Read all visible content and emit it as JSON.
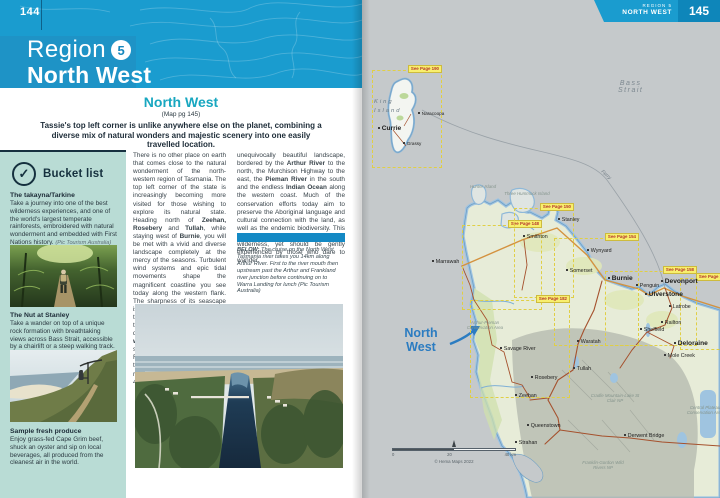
{
  "colors": {
    "header_blue": "#1a9ccf",
    "teal_heading": "#18a7c0",
    "sidebar_bg": "#b9dcd5",
    "divider_bar": "#1489c4",
    "map_sea": "#c5c9cb",
    "inset_yellow": "#f8ef6e",
    "nw_label_blue": "#2b7cc1"
  },
  "page_left": {
    "page_number": "144",
    "header": {
      "region_label": "Region",
      "region_number": "5",
      "region_name": "North West"
    },
    "section": {
      "title": "North West",
      "map_ref": "(Map pg 145)",
      "intro": "Tassie's top left corner is unlike anywhere else on the planet, combining a diverse mix of natural wonders and majestic scenery into one easily travelled location."
    },
    "bucket_list": {
      "title": "Bucket list",
      "icon": "check-circle",
      "items": [
        {
          "title": "The takayna/Tarkine",
          "body": "Take a journey into one of the best wilderness experiences, and one of the world's largest temperate rainforests, embroidered with natural wonderment and embedded with First Nations history.",
          "credit": "(Pic Tourism Australia)"
        },
        {
          "title": "The Nut at Stanley",
          "body": "Take a wander on top of a unique rock formation with breathtaking views across Bass Strait, accessible by a chairlift or a steep walking track.",
          "credit": "(Pic Lusy Productions)"
        },
        {
          "title": "Sample fresh produce",
          "body": "Enjoy grass-fed Cape Grim beef, shuck an oyster and sip on local beverages, all produced from the cleanest air in the world.",
          "credit": ""
        }
      ]
    },
    "article": {
      "col1": "There is no other place on earth that comes close to the natural wonderment of the north-western region of Tasmania. The top left corner of the state is increasingly becoming more visited for those wishing to explore its natural state. Heading north of **Zeehan, Rosebery** and **Tullah**, while staying west of **Burnie**, you will be met with a vivid and diverse landscape completely at the mercy of the seasons. Turbulent wind systems and epic tidal movements shape the magnificent coastline you see today along the western flank. The sharpness of its seascape is contrasted by the softness of the open moorlands and cool temperate rainforests found deep in the **takayna/Tarkine wilderness region**, culturally significant lands belonging to the First Nations people. The takayna/Tarkine wilderness region comprises nearly 448,000ha of",
      "col2": "unequivocally beautiful landscape, bordered by the **Arthur River** to the north, the Murchison Highway to the east, the **Pieman River** in the south and the endless **Indian Ocean** along the western coast. Much of the conservation efforts today aim to preserve the Aboriginal language and cultural connection with the land, as well as the endemic biodiversity. This part of Tasmania is a vast, untamed wilderness, yet should be gently experienced by those who dare to wander.",
      "caption": "**BELOW:** The cruise on the North West Tasmania river takes you 14km along Arthur River. First to the river mouth then upstream past the Arthur and Frankland river junction before continuing on to Warra Landing for lunch (Pic Tourism Australia)"
    }
  },
  "page_right": {
    "page_number": "145",
    "corner_tab": {
      "region": "REGION 5",
      "name": "NORTH WEST"
    },
    "map": {
      "sea_label": "Bass\nStrait",
      "region_label": "North\nWest",
      "ferry_label": "Ferry",
      "king_island_label": "King\nIsland",
      "towns": [
        {
          "label": "Currie",
          "x": 16,
          "y": 125,
          "cls": "big"
        },
        {
          "label": "Naracoopa",
          "x": 56,
          "y": 111,
          "cls": "sm"
        },
        {
          "label": "Grassy",
          "x": 41,
          "y": 141,
          "cls": "sm"
        },
        {
          "label": "Marrawah",
          "x": 70,
          "y": 259
        },
        {
          "label": "Smithton",
          "x": 161,
          "y": 234
        },
        {
          "label": "Stanley",
          "x": 196,
          "y": 217
        },
        {
          "label": "Wynyard",
          "x": 225,
          "y": 248
        },
        {
          "label": "Somerset",
          "x": 204,
          "y": 268
        },
        {
          "label": "Burnie",
          "x": 246,
          "y": 275,
          "cls": "big"
        },
        {
          "label": "Penguin",
          "x": 274,
          "y": 283
        },
        {
          "label": "Ulverstone",
          "x": 283,
          "y": 291,
          "cls": "big"
        },
        {
          "label": "Devonport",
          "x": 299,
          "y": 278,
          "cls": "big"
        },
        {
          "label": "Latrobe",
          "x": 307,
          "y": 304
        },
        {
          "label": "Railton",
          "x": 299,
          "y": 320
        },
        {
          "label": "Sheffield",
          "x": 278,
          "y": 327
        },
        {
          "label": "Waratah",
          "x": 215,
          "y": 339
        },
        {
          "label": "Tullah",
          "x": 211,
          "y": 366
        },
        {
          "label": "Rosebery",
          "x": 169,
          "y": 375
        },
        {
          "label": "Zeehan",
          "x": 153,
          "y": 393
        },
        {
          "label": "Savage River",
          "x": 138,
          "y": 346
        },
        {
          "label": "Queenstown",
          "x": 165,
          "y": 423
        },
        {
          "label": "Strahan",
          "x": 153,
          "y": 440
        },
        {
          "label": "Derwent Bridge",
          "x": 262,
          "y": 433
        },
        {
          "label": "Deloraine",
          "x": 312,
          "y": 340,
          "cls": "big"
        },
        {
          "label": "Mole Creek",
          "x": 302,
          "y": 353
        }
      ],
      "areas": [
        {
          "label": "Hunter Island",
          "x": 96,
          "y": 184
        },
        {
          "label": "Three Hummock Island",
          "x": 140,
          "y": 191
        },
        {
          "label": "Arthur-Pieman Conservation Area",
          "x": 98,
          "y": 320
        },
        {
          "label": "Cradle Mountain-Lake St Clair NP",
          "x": 228,
          "y": 393
        },
        {
          "label": "Franklin-Gordon Wild Rivers NP",
          "x": 216,
          "y": 460
        },
        {
          "label": "Central Plateau Conservation Area",
          "x": 318,
          "y": 405
        }
      ],
      "insets": [
        {
          "label": "See Page 190",
          "x": 10,
          "y": 70,
          "w": 70,
          "h": 98
        },
        {
          "label": "See Page 148",
          "x": 100,
          "y": 225,
          "w": 80,
          "h": 85
        },
        {
          "label": "See Page 150",
          "x": 152,
          "y": 208,
          "w": 60,
          "h": 90
        },
        {
          "label": "See Page 154",
          "x": 192,
          "y": 238,
          "w": 85,
          "h": 108
        },
        {
          "label": "See Page 158",
          "x": 243,
          "y": 271,
          "w": 92,
          "h": 75
        },
        {
          "label": "See Page 162",
          "x": 318,
          "y": 278,
          "w": 50,
          "h": 72
        },
        {
          "label": "See Page 182",
          "x": 108,
          "y": 300,
          "w": 100,
          "h": 98
        }
      ],
      "scale": {
        "start": "0",
        "mid": "20",
        "end": "40 km",
        "credit": "© Hema Maps 2022"
      }
    }
  }
}
